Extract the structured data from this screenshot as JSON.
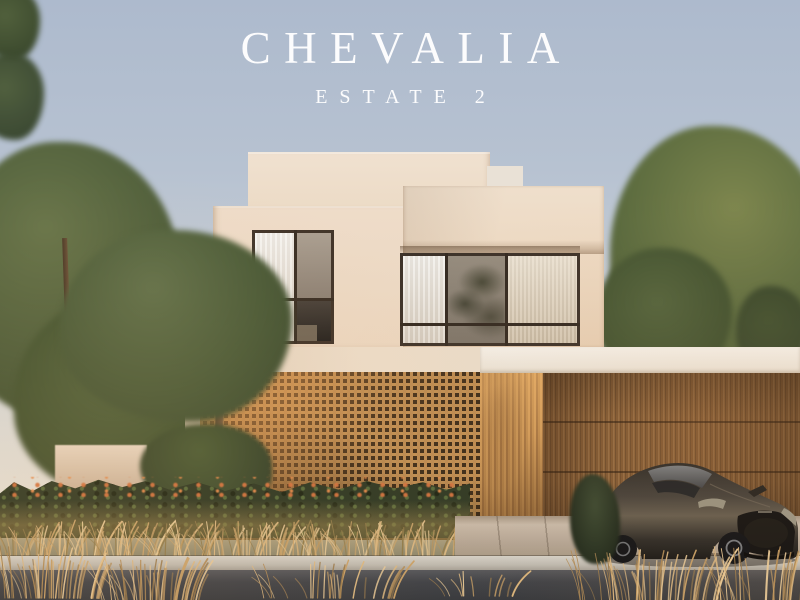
{
  "branding": {
    "title": "CHEVALIA",
    "subtitle": "ESTATE 2"
  },
  "villa": {
    "house_number": "028"
  },
  "palette": {
    "sky_top": "#adbacd",
    "sky_horizon": "#ece5d8",
    "wall_cream": "#ecdcc8",
    "beam_white": "#f3eee6",
    "lattice_wood": "#bb8a51",
    "garage_wood": "#7c5832",
    "foliage_green": "#55653c",
    "hedge_green": "#2c3723",
    "flower_orange": "#d3733f",
    "grass_gold": "#d8b57f",
    "pavement": "#bcae9e",
    "curb_grey": "#c6c1b8",
    "road_dark": "#3f4146",
    "car_body": "#3a362f",
    "title_text": "#fcfcfd",
    "number_text": "#4e4034"
  }
}
